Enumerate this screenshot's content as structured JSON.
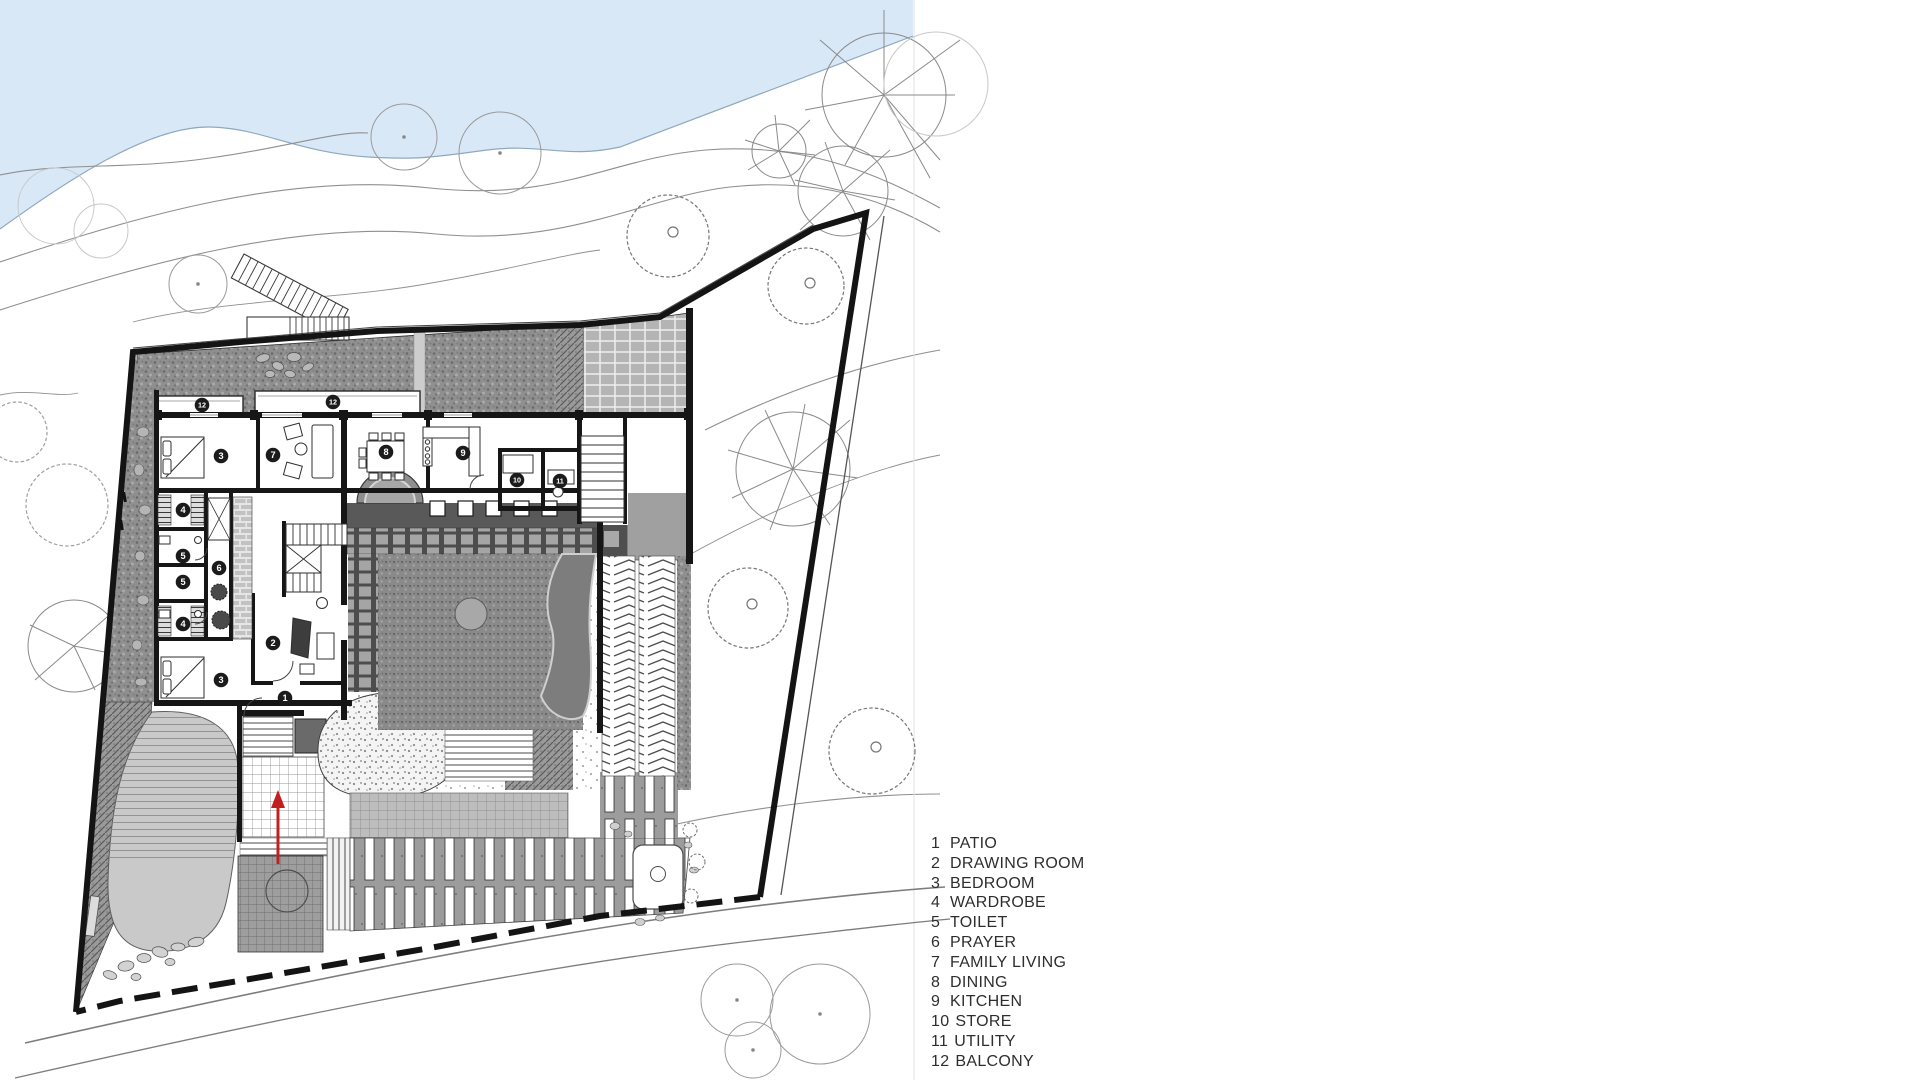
{
  "legend": {
    "items": [
      {
        "number": "1",
        "label": "PATIO"
      },
      {
        "number": "2",
        "label": "DRAWING ROOM"
      },
      {
        "number": "3",
        "label": "BEDROOM"
      },
      {
        "number": "4",
        "label": "WARDROBE"
      },
      {
        "number": "5",
        "label": "TOILET"
      },
      {
        "number": "6",
        "label": "PRAYER"
      },
      {
        "number": "7",
        "label": "FAMILY LIVING"
      },
      {
        "number": "8",
        "label": "DINING"
      },
      {
        "number": "9",
        "label": "KITCHEN"
      },
      {
        "number": "10",
        "label": "STORE"
      },
      {
        "number": "11",
        "label": "UTILITY"
      },
      {
        "number": "12",
        "label": "BALCONY"
      }
    ]
  },
  "plan": {
    "room_markers": [
      {
        "n": "12",
        "x": 202,
        "y": 405
      },
      {
        "n": "12",
        "x": 333,
        "y": 402
      },
      {
        "n": "3",
        "x": 221,
        "y": 456
      },
      {
        "n": "7",
        "x": 273,
        "y": 455
      },
      {
        "n": "8",
        "x": 386,
        "y": 452
      },
      {
        "n": "9",
        "x": 463,
        "y": 453
      },
      {
        "n": "10",
        "x": 517,
        "y": 480
      },
      {
        "n": "11",
        "x": 560,
        "y": 481
      },
      {
        "n": "4",
        "x": 183,
        "y": 510
      },
      {
        "n": "5",
        "x": 183,
        "y": 556
      },
      {
        "n": "5",
        "x": 183,
        "y": 582
      },
      {
        "n": "4",
        "x": 183,
        "y": 624
      },
      {
        "n": "6",
        "x": 219,
        "y": 568
      },
      {
        "n": "2",
        "x": 273,
        "y": 643
      },
      {
        "n": "3",
        "x": 221,
        "y": 680
      },
      {
        "n": "1",
        "x": 285,
        "y": 698
      }
    ],
    "colors": {
      "water": "#d9e8f7",
      "shore": "#8fa8bf",
      "contour": "#8f8f8f",
      "boundary": "#141414",
      "terrace": "#8f8f8f",
      "lawn": "#c9c9c9",
      "veranda": "#595959",
      "arrow": "#c41f1f",
      "marker": "#1b1b1b"
    }
  }
}
